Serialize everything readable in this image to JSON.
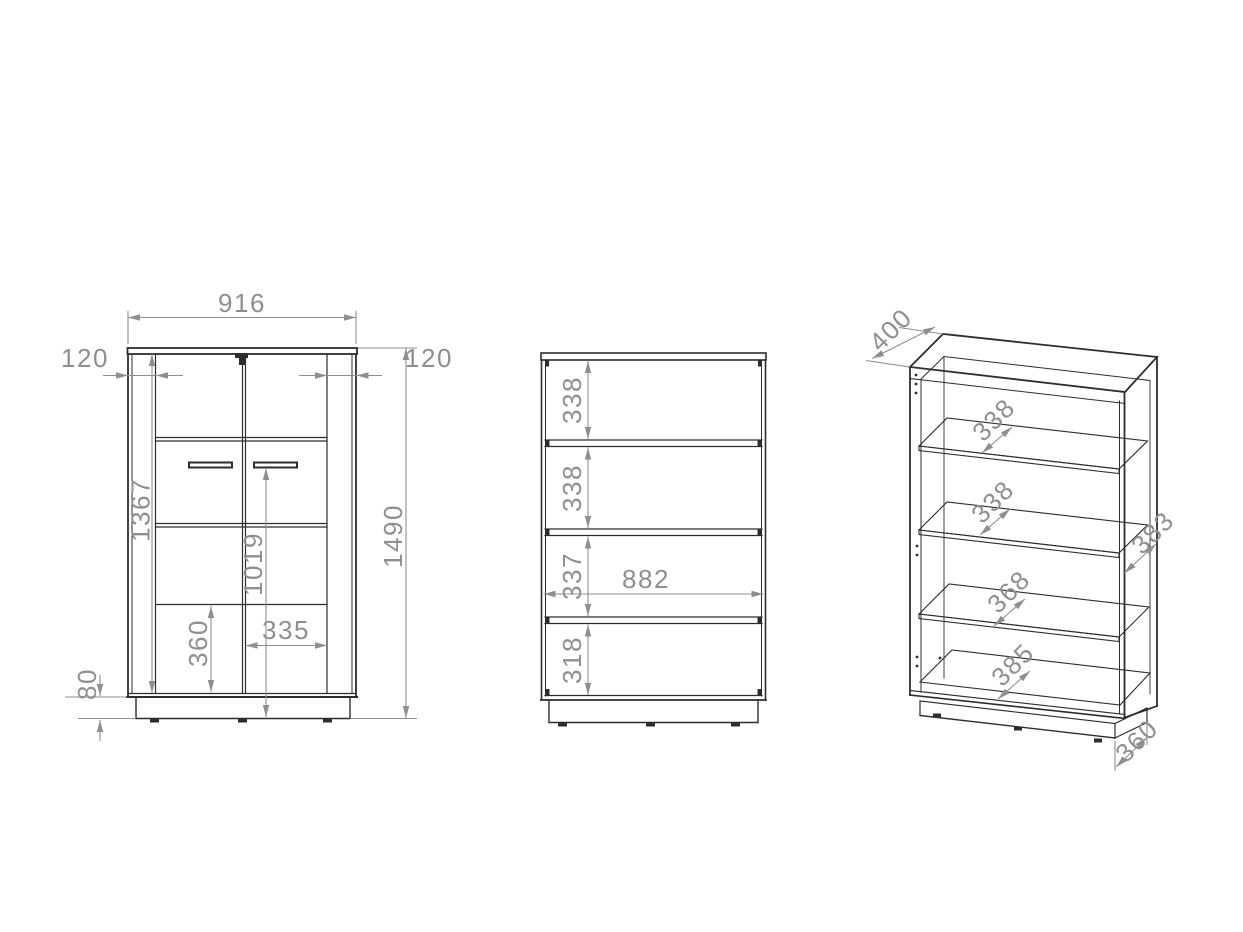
{
  "drawing": {
    "type": "furniture-technical-drawing",
    "views": [
      "front-view",
      "internal-front-view",
      "isometric-view"
    ]
  },
  "views": {
    "front": {
      "dims": {
        "overall_width": "916",
        "side_panel_left": "120",
        "side_panel_right": "120",
        "front_height": "1367",
        "handle_height": "1019",
        "lower_door_height": "360",
        "door_width": "335",
        "plinth_height": "80",
        "overall_height": "1490"
      }
    },
    "internal": {
      "dims": {
        "compartment_1": "338",
        "compartment_2": "338",
        "compartment_3": "337",
        "inner_width": "882",
        "compartment_4": "318"
      }
    },
    "isometric": {
      "dims": {
        "top_depth": "400",
        "shelf_1_depth": "338",
        "shelf_2_depth": "338",
        "shelf_3_depth": "368",
        "bottom_shelf_depth": "385",
        "side_panel_depth": "383",
        "plinth_depth": "360"
      }
    }
  },
  "colors": {
    "line": "#2d2d2d",
    "dimension": "#8f8f8f",
    "background": "#ffffff"
  }
}
